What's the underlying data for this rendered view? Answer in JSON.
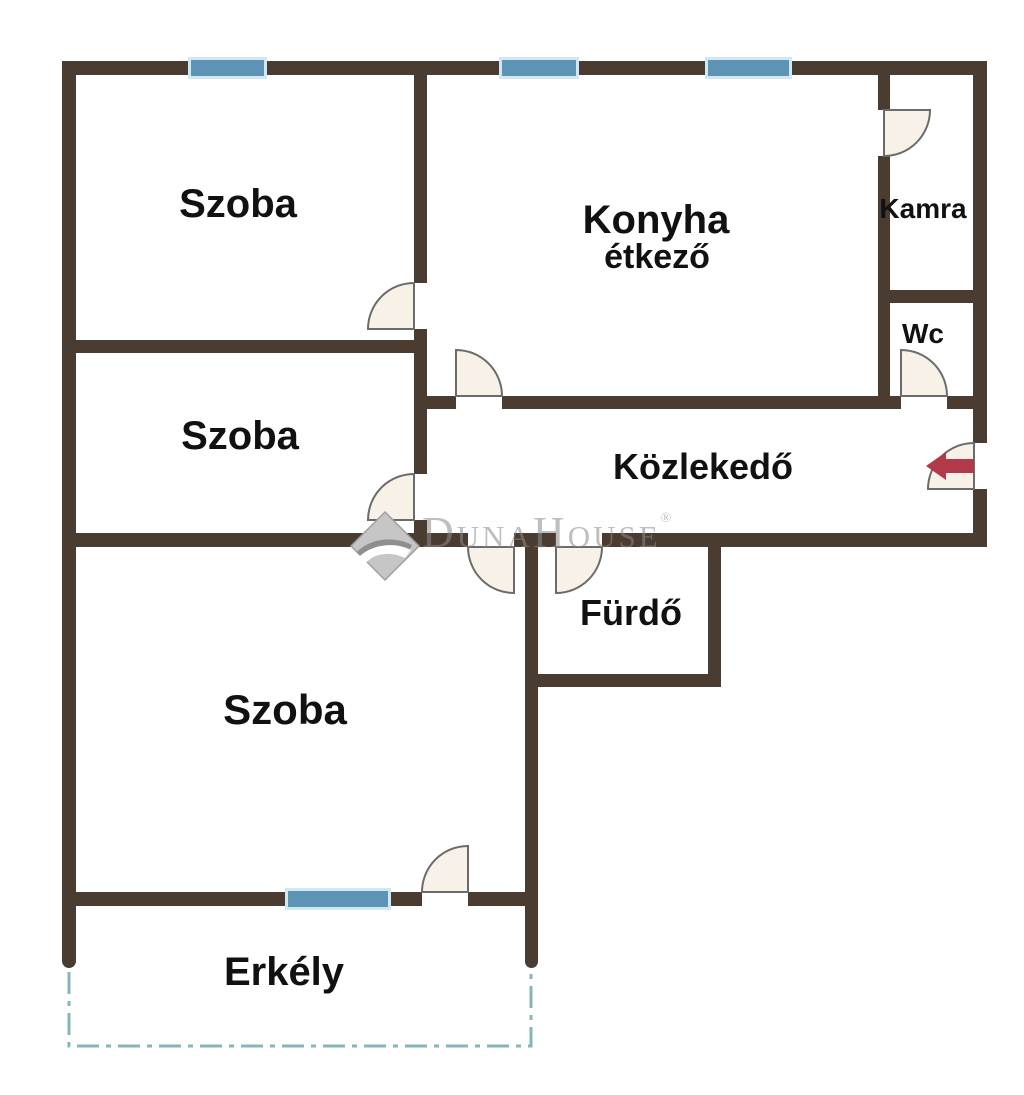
{
  "document": {
    "type": "apartment-floor-plan",
    "background": "#ffffff"
  },
  "colors": {
    "wall": "#4a3c31",
    "window": "#5d94b6",
    "window_halo": "#cfe8f2",
    "door_fill": "#f8f1e7",
    "door_stroke": "#6b6b6b",
    "entry_arrow": "#b2394a",
    "balcony_dash": "#86b6ba",
    "label_text": "#111111",
    "watermark": "#8a8a8a"
  },
  "rooms": {
    "szoba_top": {
      "label": "Szoba"
    },
    "szoba_mid": {
      "label": "Szoba"
    },
    "szoba_big": {
      "label": "Szoba"
    },
    "konyha": {
      "label": "Konyha",
      "sublabel": "étkező"
    },
    "kamra": {
      "label": "Kamra"
    },
    "wc": {
      "label": "Wc"
    },
    "kozlekedo": {
      "label": "Közlekedő"
    },
    "furdo": {
      "label": "Fürdő"
    },
    "erkely": {
      "label": "Erkély"
    }
  },
  "symbols": {
    "windows_count": 4,
    "doors_count": 9,
    "entrance_arrow": "left"
  },
  "watermark": {
    "brand": "DunaHouse",
    "registered": "®"
  }
}
